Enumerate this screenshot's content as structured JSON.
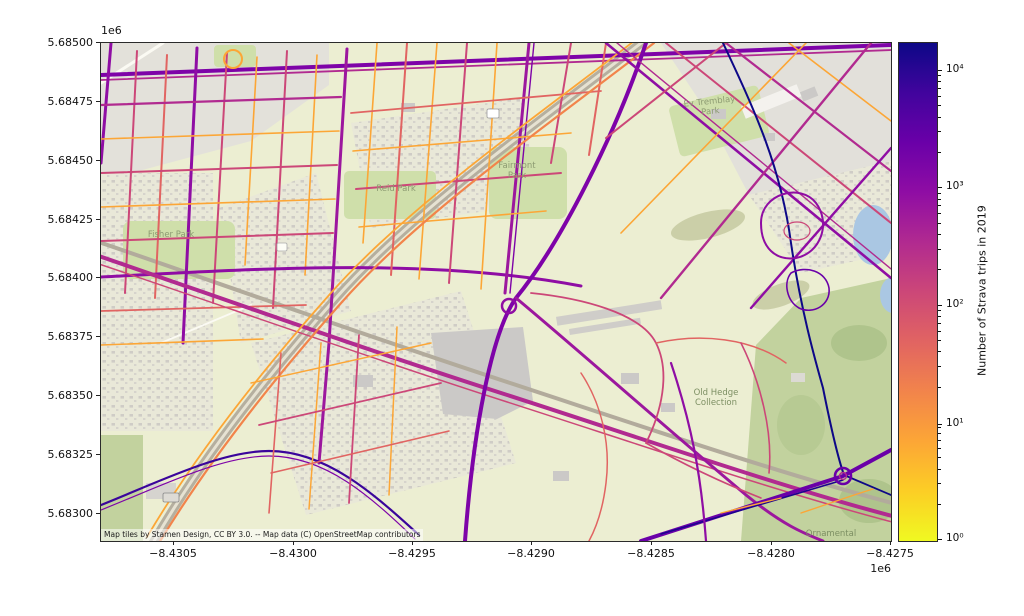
{
  "figure": {
    "background_color": "#ffffff",
    "x_axis": {
      "ticks": [
        "−8.4305",
        "−8.4300",
        "−8.4295",
        "−8.4290",
        "−8.4285",
        "−8.4280",
        "−8.4275"
      ],
      "offset_label": "1e6"
    },
    "y_axis": {
      "ticks": [
        "5.68500",
        "5.68475",
        "5.68450",
        "5.68425",
        "5.68400",
        "5.68375",
        "5.68350",
        "5.68325",
        "5.68300"
      ],
      "offset_label": "1e6"
    }
  },
  "colorbar": {
    "label": "Number of Strava trips in 2019",
    "ticks": [
      "10⁴",
      "10³",
      "10²",
      "10¹",
      "10⁰"
    ],
    "tick_values": [
      10000,
      1000,
      100,
      10,
      1
    ],
    "scale": "log",
    "colormap": "plasma reversed (yellow = low, dark navy = high)",
    "gradient_top_to_bottom": [
      "#0d0887",
      "#41049d",
      "#6a00a8",
      "#8f0da4",
      "#b12a90",
      "#cc4778",
      "#e16462",
      "#f2844b",
      "#fca636",
      "#fcce25",
      "#f0f921"
    ]
  },
  "map": {
    "attribution": "Map tiles by Stamen Design, CC BY 3.0. -- Map data (C) OpenStreetMap contributors",
    "labels": {
      "fisher_park": {
        "text": "Fisher Park"
      },
      "reid_park": {
        "text": "Reid Park"
      },
      "fairmont_park": {
        "text": "Fairmont Park"
      },
      "ev_tremblay_park": {
        "text": "Ev Tremblay Park"
      },
      "old_hedge_collection": {
        "text": "Old Hedge Collection"
      },
      "ornamental": {
        "text": "Ornamental"
      }
    },
    "basemap_colors": {
      "land": "#eceed2",
      "residential": "#e5e3da",
      "park_green": "#cfdfaa",
      "arboretum_green": "#c2d29e",
      "water": "#aac7e3",
      "building_gray": "#cbc9c7",
      "rail_gray": "#b2ab9c"
    }
  },
  "chart_data": {
    "type": "map",
    "description": "Street network colored by number of Strava trips in 2019 over a Stamen/OSM basemap (Ottawa area)",
    "x_tick_values_1e6": [
      -8.4305,
      -8.43,
      -8.4295,
      -8.429,
      -8.4285,
      -8.428,
      -8.4275
    ],
    "y_tick_values_1e6": [
      5.685,
      5.68475,
      5.6845,
      5.68425,
      5.684,
      5.68375,
      5.6835,
      5.68325,
      5.683
    ],
    "color_scale": {
      "type": "log",
      "min": 1,
      "max": 10000,
      "legend": "Number of Strava trips in 2019"
    },
    "legend_position": "right colorbar"
  }
}
